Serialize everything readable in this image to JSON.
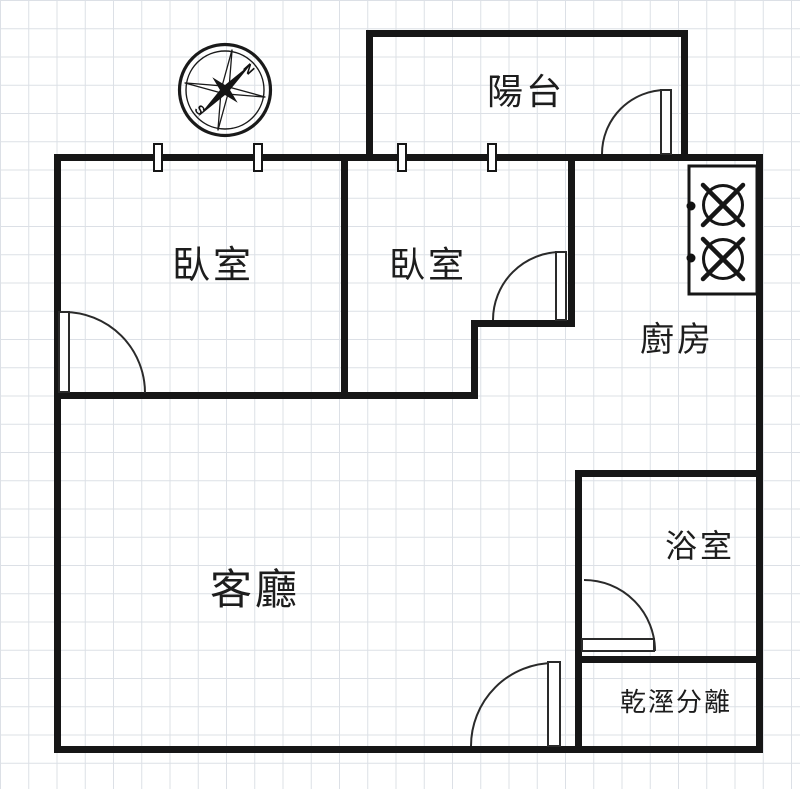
{
  "document": {
    "type": "apartment-floor-plan"
  },
  "rooms": {
    "balcony": {
      "label": "陽台"
    },
    "bedroom_1": {
      "label": "臥室"
    },
    "bedroom_2": {
      "label": "臥室"
    },
    "kitchen": {
      "label": "廚房"
    },
    "living_room": {
      "label": "客廳"
    },
    "bathroom": {
      "label": "浴室"
    },
    "dry_wet_separation": {
      "label": "乾溼分離"
    }
  },
  "compass": {
    "north_label": "N",
    "south_label": "S"
  },
  "fixtures": {
    "stove_burner_count": 2,
    "window_marker_count": 4,
    "door_count": 5
  },
  "colors": {
    "wall": "#161616",
    "door_line": "#2a2a2a",
    "grid_line": "#dce0e6",
    "background": "#ffffff",
    "text": "#1d1d1d"
  }
}
